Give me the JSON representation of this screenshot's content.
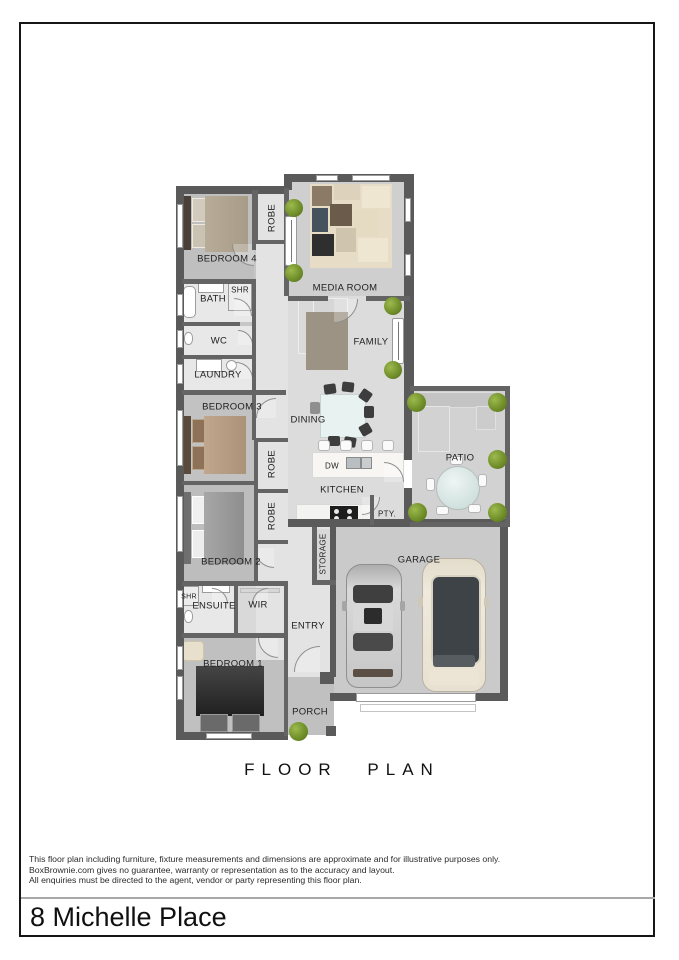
{
  "title": {
    "floor_plan": "FLOOR PLAN"
  },
  "address": "8 Michelle Place",
  "disclaimer": {
    "line1": "This floor plan including furniture, fixture measurements and dimensions are approximate and for illustrative purposes only.",
    "line2": "BoxBrownie.com gives no guarantee, warranty or representation as to the accuracy and layout.",
    "line3": "All enquiries must be directed to the agent, vendor or party representing this floor plan."
  },
  "rooms": {
    "bedroom1": "BEDROOM 1",
    "bedroom2": "BEDROOM 2",
    "bedroom3": "BEDROOM 3",
    "bedroom4": "BEDROOM 4",
    "media": "MEDIA ROOM",
    "family": "FAMILY",
    "dining": "DINING",
    "kitchen": "KITCHEN",
    "bath": "BATH",
    "wc": "WC",
    "laundry": "LAUNDRY",
    "ensuite": "ENSUITE",
    "wir": "WIR",
    "robe": "ROBE",
    "shr": "SHR",
    "dw": "DW",
    "pty": "PTY.",
    "storage": "STORAGE",
    "garage": "GARAGE",
    "entry": "ENTRY",
    "porch": "PORCH",
    "patio": "PATIO"
  },
  "colors": {
    "wall": "#5a5a5a",
    "floor_light": "#dcdcdc",
    "floor_carpet": "#c2c2c2",
    "bush_green": "#6e8c27",
    "car_silver": "#c9c9c9",
    "car_white": "#efe9dc"
  }
}
